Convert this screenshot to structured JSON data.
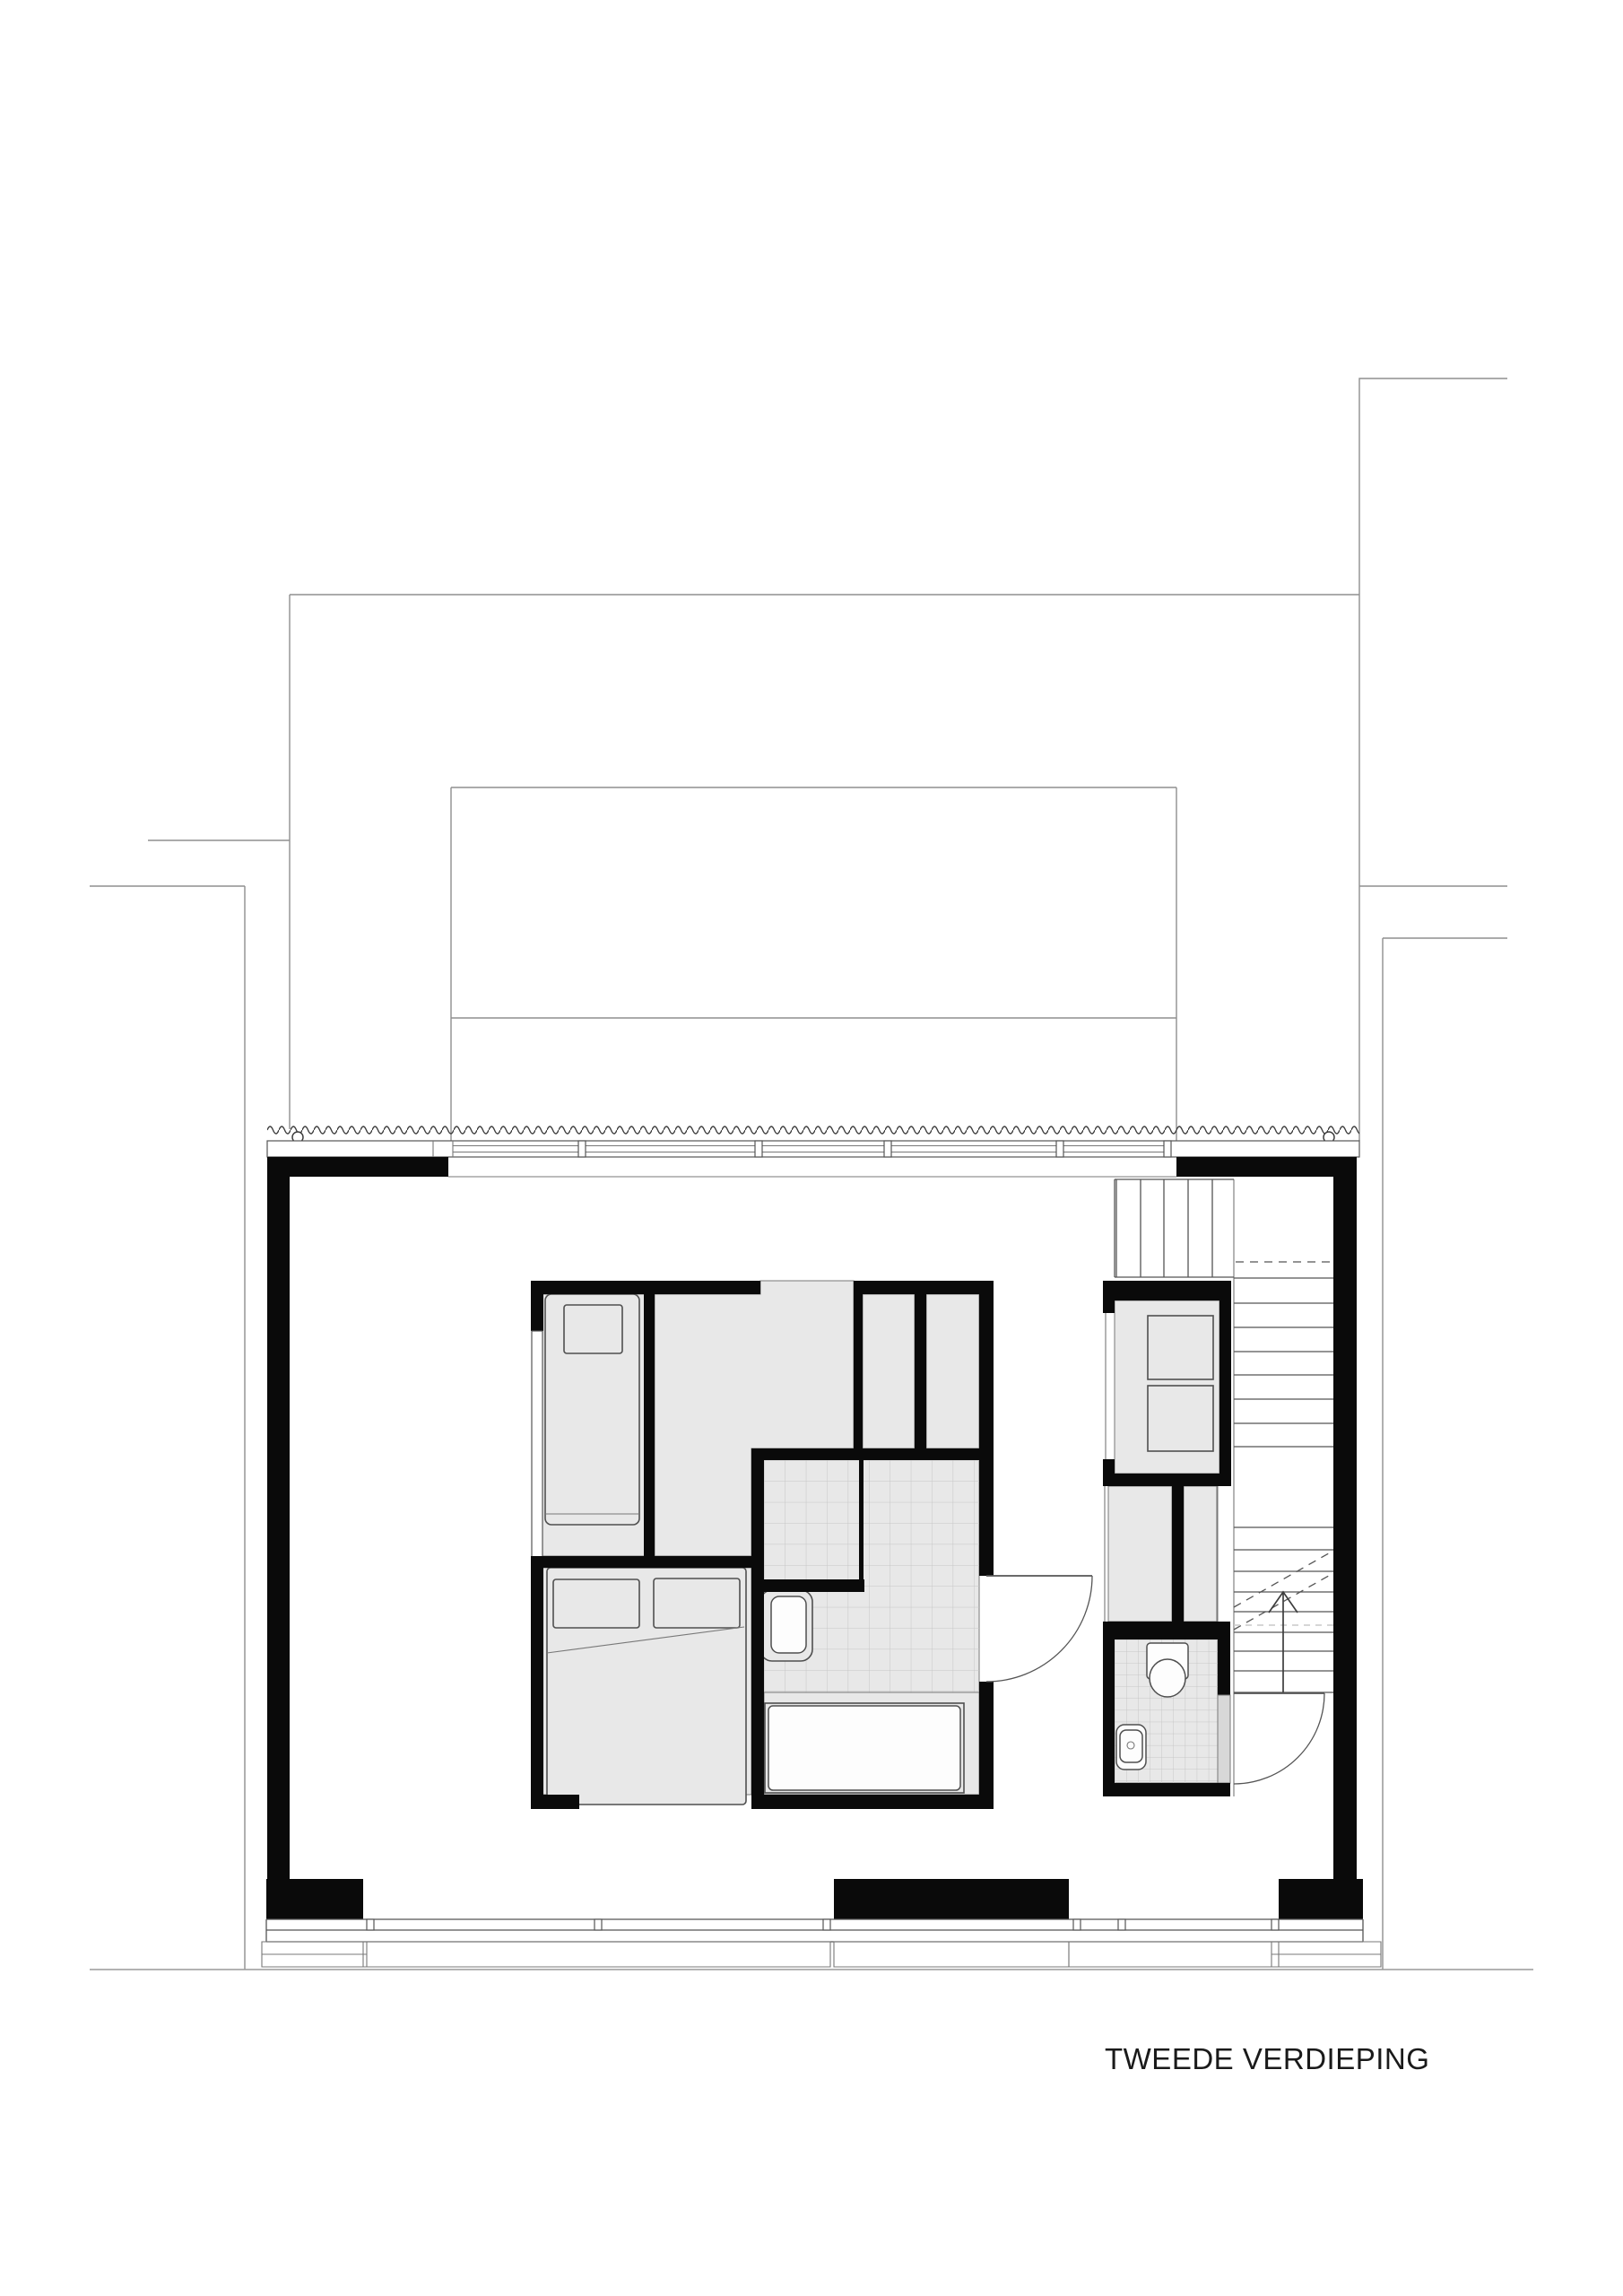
{
  "drawing": {
    "floor_label": "TWEEDE VERDIEPING"
  },
  "colors": {
    "wall": "#0a0a0a",
    "room": "#e8e8e8",
    "edge": "#787878",
    "line": "#555555",
    "ctx": "#8f8f8f",
    "furn": "#4f4f4f",
    "tile": "#c6c6c6",
    "lightdash": "#c9c9c9",
    "partition": "#d8d8d8",
    "textcol": "#1a1a1a",
    "background": "#ffffff"
  }
}
